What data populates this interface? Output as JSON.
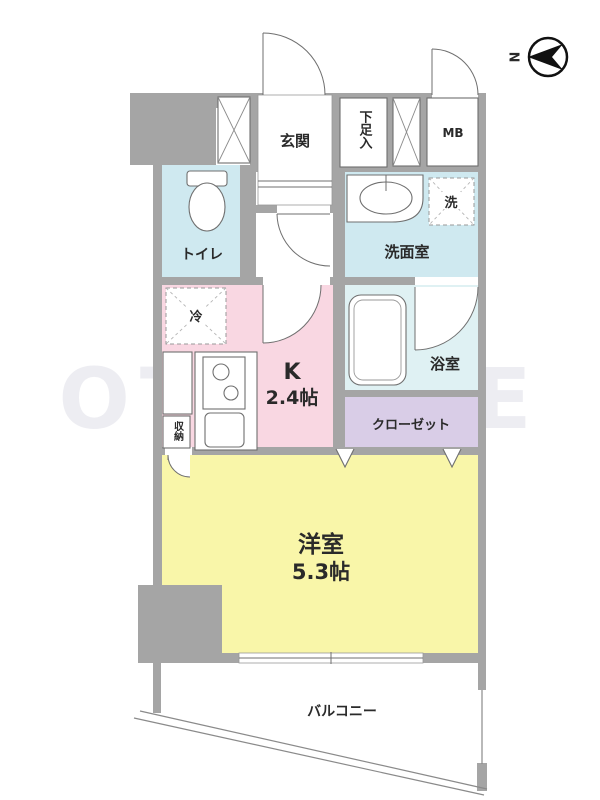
{
  "floorplan": {
    "compass": {
      "north_label": "N"
    },
    "rooms": {
      "genkan": {
        "label": "玄関"
      },
      "shoe_storage": {
        "label": "下足入"
      },
      "meter_box": {
        "label": "MB"
      },
      "toilet": {
        "label": "トイレ"
      },
      "washroom": {
        "label": "洗面室"
      },
      "washing_machine": {
        "label": "洗"
      },
      "refrigerator": {
        "label": "冷"
      },
      "kitchen": {
        "label": "K",
        "size": "2.4帖"
      },
      "bathroom": {
        "label": "浴室"
      },
      "closet": {
        "label": "クローゼット"
      },
      "storage": {
        "label": "収納"
      },
      "western_room": {
        "label": "洋室",
        "size": "5.3帖"
      },
      "balcony": {
        "label": "バルコニー"
      }
    },
    "watermark": "OT CORE",
    "colors": {
      "wall": "#a5a5a5",
      "water_rooms": "#cfe9f0",
      "bathroom": "#dff1f3",
      "kitchen": "#f9d7e2",
      "main_room": "#f9f6a9",
      "closet": "#d9cde7"
    }
  }
}
